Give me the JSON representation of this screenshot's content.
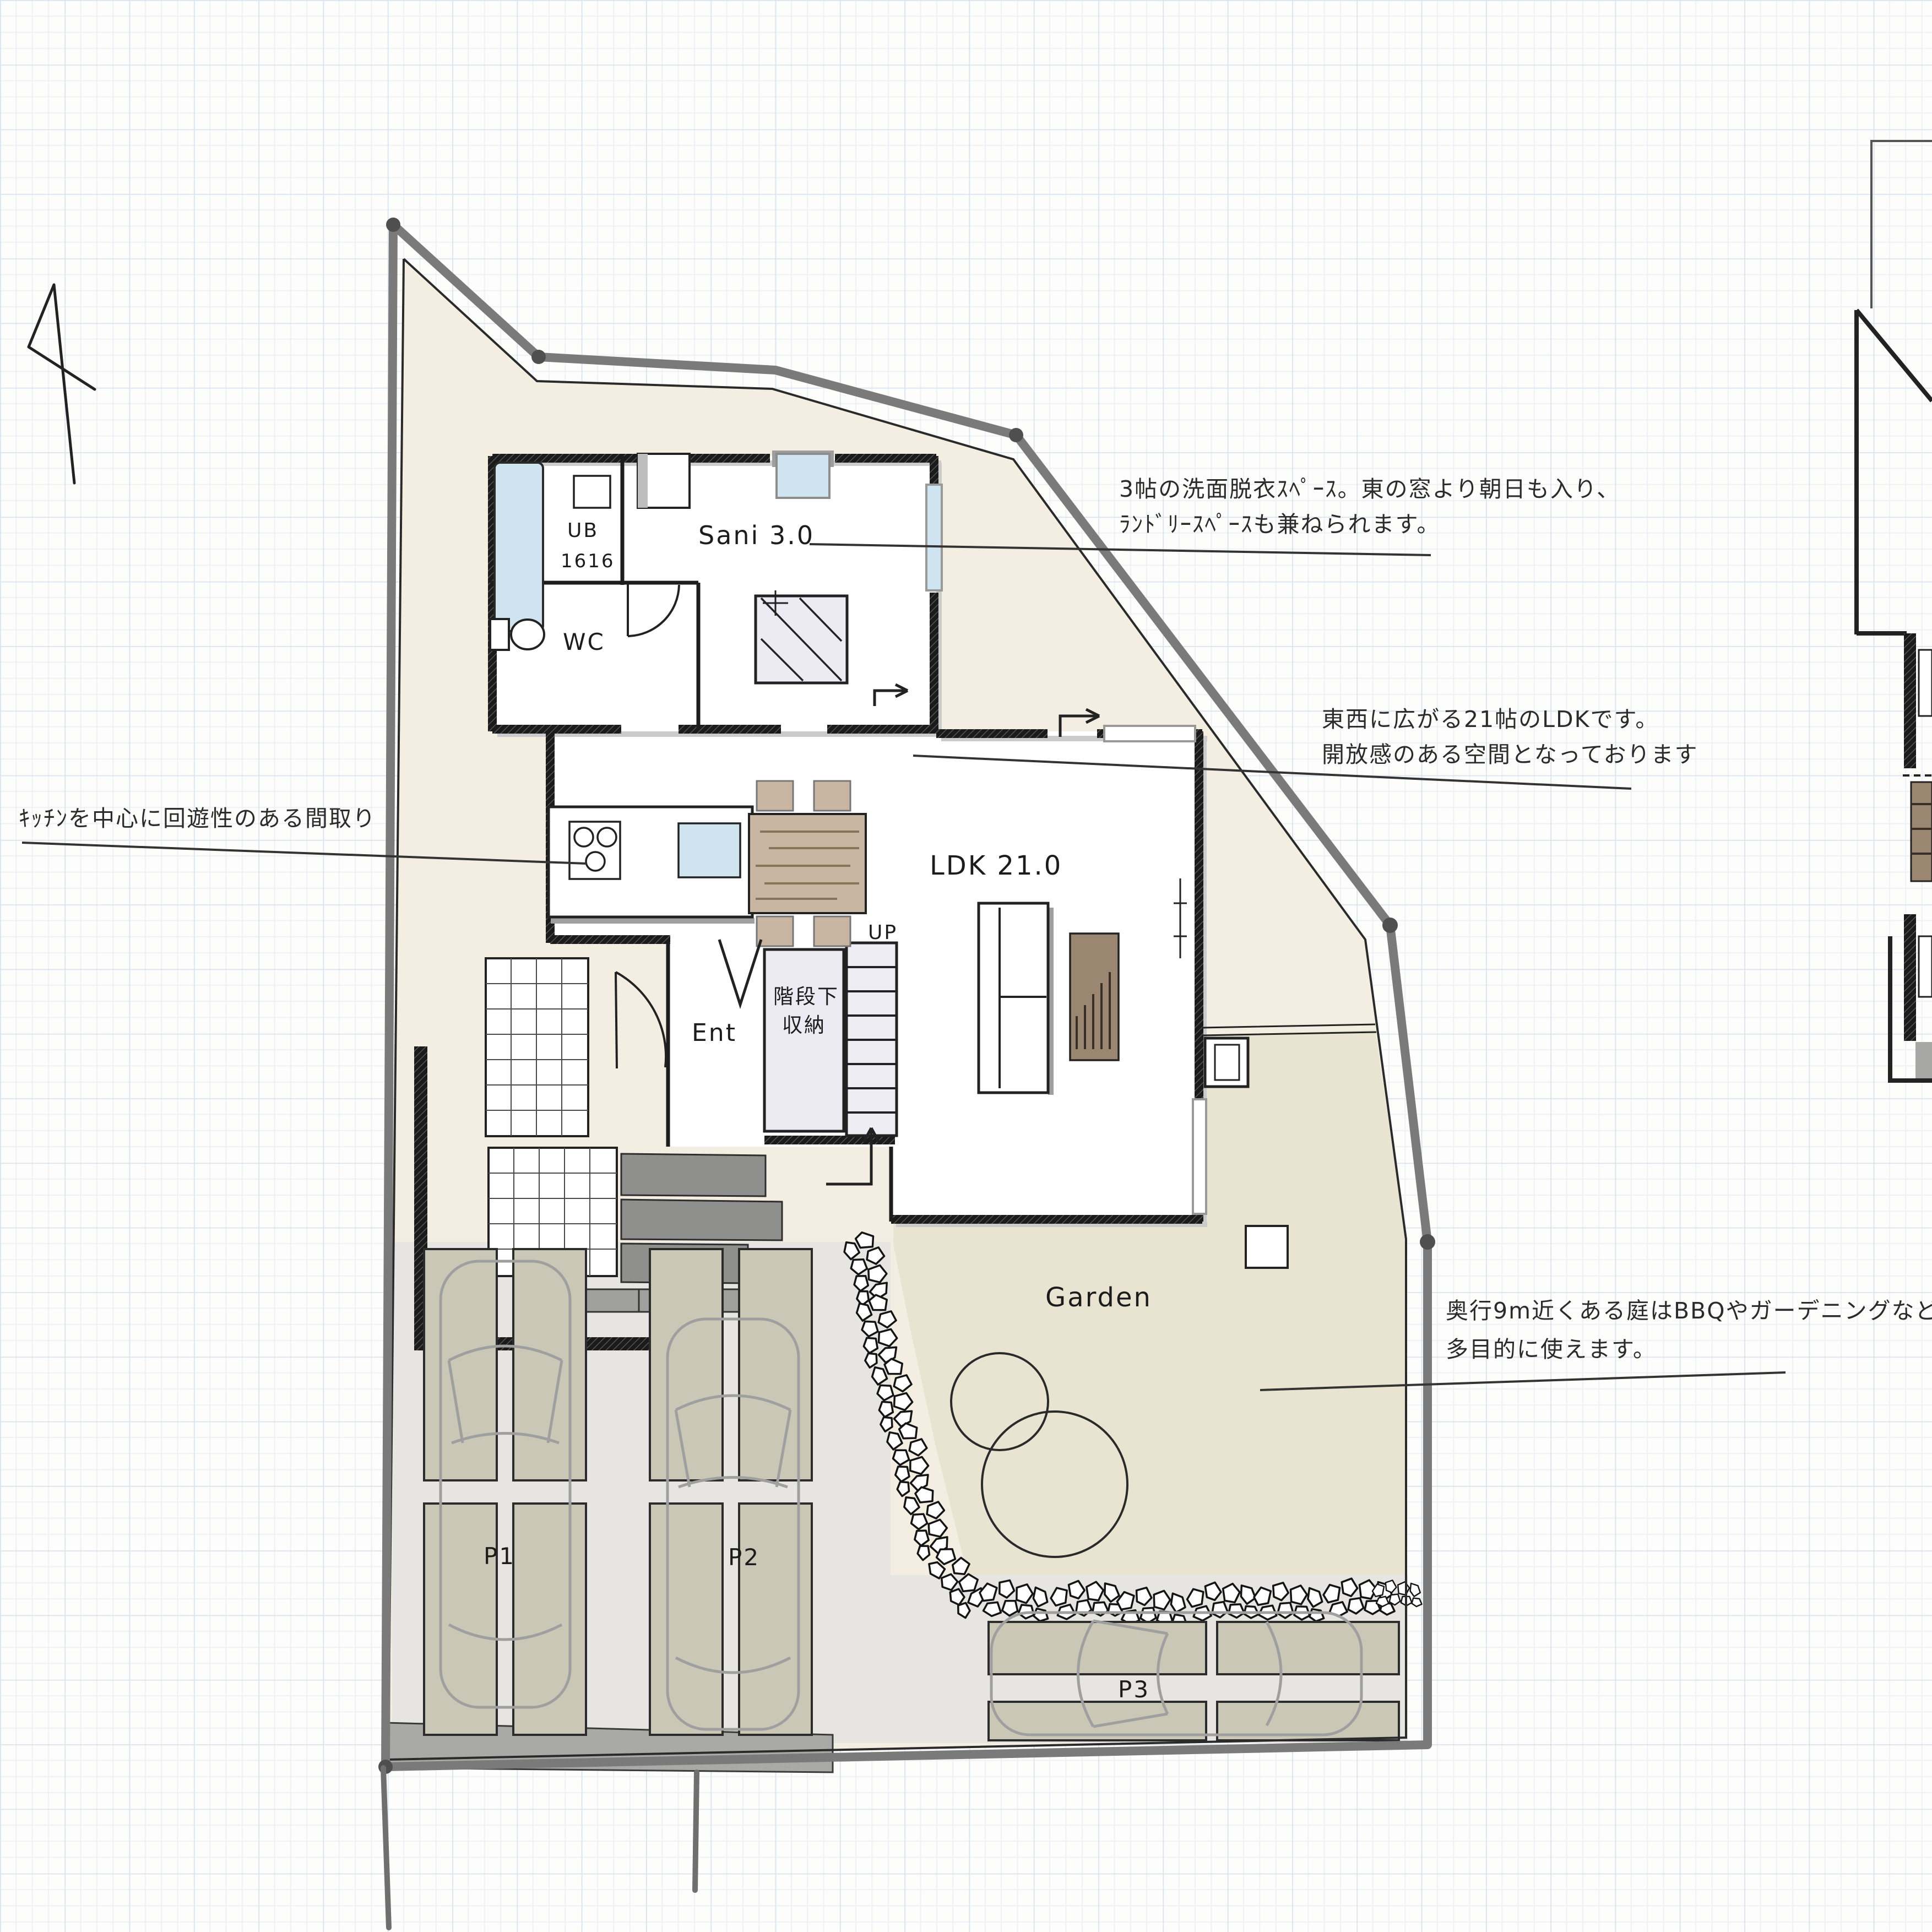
{
  "annotations": {
    "sani": {
      "line1": "3帖の洗面脱衣ｽﾍﾟｰｽ。東の窓より朝日も入り、",
      "line2": "ﾗﾝﾄﾞﾘｰｽﾍﾟｰｽも兼ねられます。"
    },
    "ldk": {
      "line1": "東西に広がる21帖のLDKです。",
      "line2": "開放感のある空間となっております"
    },
    "kitchen": {
      "line1": "ｷｯﾁﾝを中心に回遊性のある間取り"
    },
    "garden": {
      "line1": "奥行9m近くある庭はBBQやガーデニングなど",
      "line2": "多目的に使えます。"
    }
  },
  "rooms": {
    "ub": {
      "label": "UB",
      "size": "1616"
    },
    "sani": {
      "label": "Sani 3.0"
    },
    "wc": {
      "label": "WC"
    },
    "ldk": {
      "label": "LDK 21.0"
    },
    "ent": {
      "label": "Ent"
    },
    "stair_storage": {
      "line1": "階段下",
      "line2": "収納"
    },
    "stairs": {
      "label": "UP"
    }
  },
  "outdoor": {
    "garden": {
      "label": "Garden"
    },
    "parking": [
      {
        "label": "P1"
      },
      {
        "label": "P2"
      },
      {
        "label": "P3"
      }
    ]
  },
  "colors": {
    "site_cream": "#f3eee1",
    "garden_khaki": "#e9e4d1",
    "parking_gray": "#e6e5e2",
    "slab_tan": "#cbc7b6",
    "window_glass": "#cfe4ee",
    "wood_table": "#c9b6a2",
    "wood_dark": "#9b8672",
    "storage_lavender": "#eceaf2",
    "step_gray": "#8f8f8e",
    "driveway_gray": "#a9a9a7",
    "boundary_gray": "#7a7a7a",
    "ink": "#1d1d1d"
  }
}
